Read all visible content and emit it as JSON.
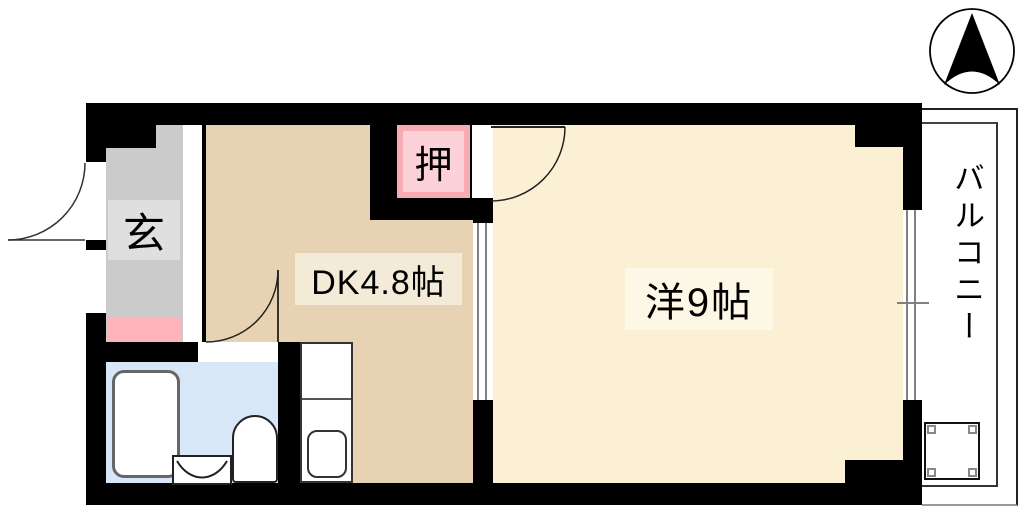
{
  "plan": {
    "type": "apartment-floor-plan",
    "compass": {
      "direction": "N",
      "icon": "north-arrow-icon"
    },
    "rooms": {
      "entrance": {
        "label": "玄"
      },
      "dining_kitchen": {
        "label": "DK4.8帖"
      },
      "closet": {
        "label": "押"
      },
      "western_room": {
        "label": "洋9帖"
      },
      "balcony": {
        "label": "バルコニー"
      }
    },
    "fixtures": [
      "bathtub",
      "toilet",
      "wash-basin",
      "kitchen-counter",
      "kitchen-sink",
      "washing-machine-pan",
      "sliding-door",
      "balcony-window",
      "entrance-door",
      "bathroom-door",
      "western-room-door"
    ],
    "colors": {
      "wall": "#000000",
      "dk_floor": "#e7d3b4",
      "western_floor": "#fbf0d3",
      "entrance_floor": "#cbcbcb",
      "entrance_label_box": "#dfdfdf",
      "entrance_mat": "#ffb3ba",
      "closet": "#f7abb5",
      "closet_inner": "#fcd2d8",
      "bathroom_floor": "#d7e7f7",
      "dk_label_box": "#f3ead8",
      "western_label_box": "#fdf8e6"
    }
  }
}
